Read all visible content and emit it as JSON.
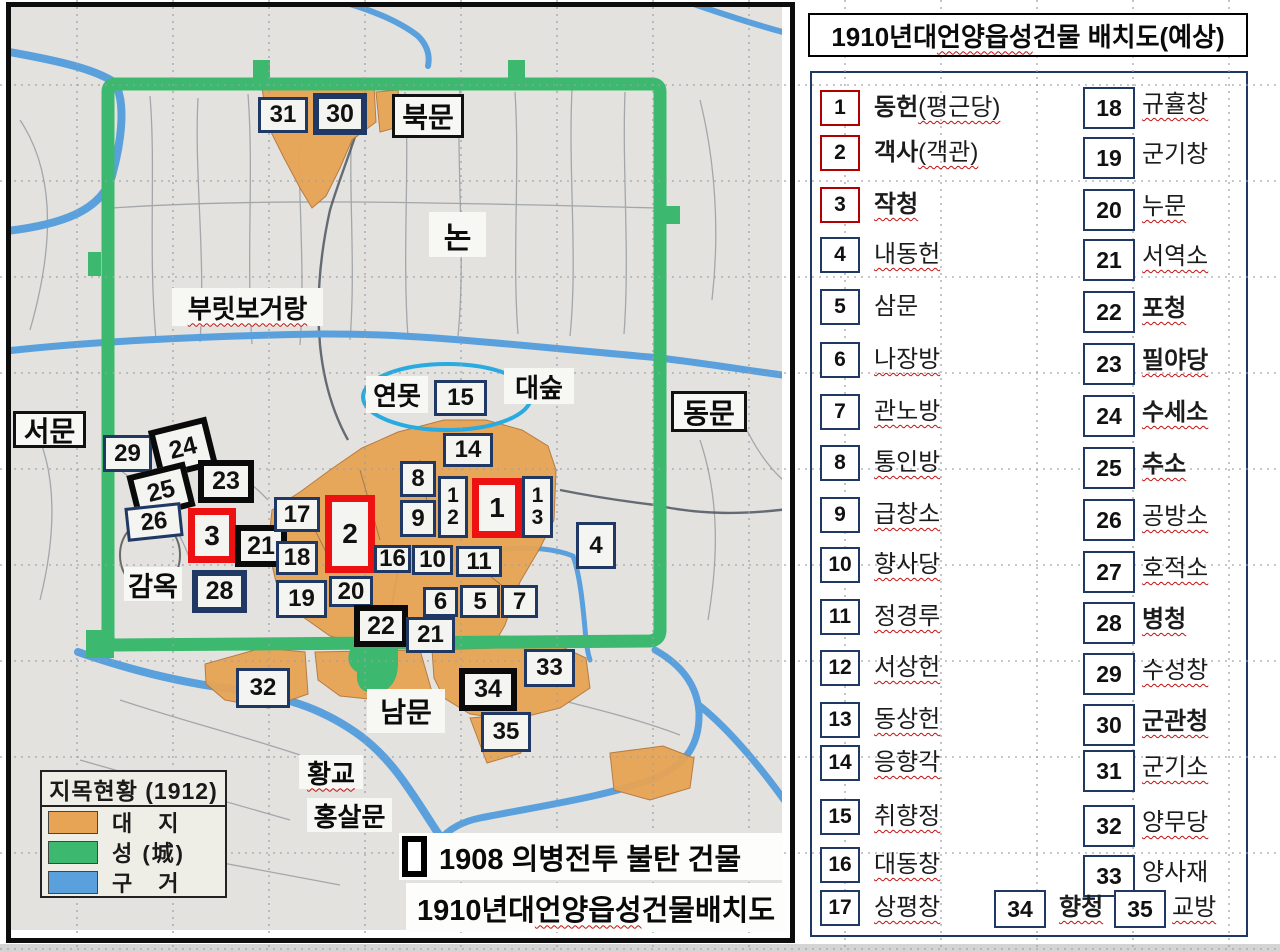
{
  "panel": {
    "title": {
      "prefix": "1910년대 ",
      "underlined": "언양읍성",
      "suffix": " 건물 배치도(예상)"
    },
    "items": [
      {
        "no": "1",
        "label": "동헌",
        "paren": "(평근당)",
        "bold": true,
        "red": true,
        "wavy": true,
        "col": "L"
      },
      {
        "no": "2",
        "label": "객사",
        "paren": "(객관)",
        "bold": true,
        "red": true,
        "wavy": true,
        "col": "L"
      },
      {
        "no": "3",
        "label": "작청",
        "paren": "",
        "bold": true,
        "red": true,
        "wavy": true,
        "col": "L"
      },
      {
        "no": "4",
        "label": "내동헌",
        "paren": "",
        "bold": false,
        "red": false,
        "wavy": true,
        "col": "L"
      },
      {
        "no": "5",
        "label": "삼문",
        "paren": "",
        "bold": false,
        "red": false,
        "wavy": false,
        "col": "L"
      },
      {
        "no": "6",
        "label": "나장방",
        "paren": "",
        "bold": false,
        "red": false,
        "wavy": true,
        "col": "L"
      },
      {
        "no": "7",
        "label": "관노방",
        "paren": "",
        "bold": false,
        "red": false,
        "wavy": true,
        "col": "L"
      },
      {
        "no": "8",
        "label": "통인방",
        "paren": "",
        "bold": false,
        "red": false,
        "wavy": true,
        "col": "L"
      },
      {
        "no": "9",
        "label": "급창소",
        "paren": "",
        "bold": false,
        "red": false,
        "wavy": true,
        "col": "L"
      },
      {
        "no": "10",
        "label": "향사당",
        "paren": "",
        "bold": false,
        "red": false,
        "wavy": true,
        "col": "L"
      },
      {
        "no": "11",
        "label": "정경루",
        "paren": "",
        "bold": false,
        "red": false,
        "wavy": true,
        "col": "L"
      },
      {
        "no": "12",
        "label": "서상헌",
        "paren": "",
        "bold": false,
        "red": false,
        "wavy": true,
        "col": "L"
      },
      {
        "no": "13",
        "label": "동상헌",
        "paren": "",
        "bold": false,
        "red": false,
        "wavy": true,
        "col": "L"
      },
      {
        "no": "14",
        "label": "응향각",
        "paren": "",
        "bold": false,
        "red": false,
        "wavy": true,
        "col": "L"
      },
      {
        "no": "15",
        "label": "취향정",
        "paren": "",
        "bold": false,
        "red": false,
        "wavy": true,
        "col": "L"
      },
      {
        "no": "16",
        "label": "대동창",
        "paren": "",
        "bold": false,
        "red": false,
        "wavy": true,
        "col": "L"
      },
      {
        "no": "17",
        "label": "상평창",
        "paren": "",
        "bold": false,
        "red": false,
        "wavy": true,
        "col": "L"
      },
      {
        "no": "18",
        "label": "규휼창",
        "paren": "",
        "bold": false,
        "red": false,
        "wavy": true,
        "col": "R"
      },
      {
        "no": "19",
        "label": "군기창",
        "paren": "",
        "bold": false,
        "red": false,
        "wavy": false,
        "col": "R"
      },
      {
        "no": "20",
        "label": "누문",
        "paren": "",
        "bold": false,
        "red": false,
        "wavy": true,
        "col": "R"
      },
      {
        "no": "21",
        "label": "서역소",
        "paren": "",
        "bold": false,
        "red": false,
        "wavy": true,
        "col": "R"
      },
      {
        "no": "22",
        "label": "포청",
        "paren": "",
        "bold": true,
        "red": false,
        "wavy": true,
        "col": "R"
      },
      {
        "no": "23",
        "label": "필야당",
        "paren": "",
        "bold": true,
        "red": false,
        "wavy": true,
        "col": "R"
      },
      {
        "no": "24",
        "label": "수세소",
        "paren": "",
        "bold": true,
        "red": false,
        "wavy": true,
        "col": "R"
      },
      {
        "no": "25",
        "label": "추소",
        "paren": "",
        "bold": true,
        "red": false,
        "wavy": true,
        "col": "R"
      },
      {
        "no": "26",
        "label": "공방소",
        "paren": "",
        "bold": false,
        "red": false,
        "wavy": true,
        "col": "R"
      },
      {
        "no": "27",
        "label": "호적소",
        "paren": "",
        "bold": false,
        "red": false,
        "wavy": true,
        "col": "R"
      },
      {
        "no": "28",
        "label": "병청",
        "paren": "",
        "bold": true,
        "red": false,
        "wavy": true,
        "col": "R"
      },
      {
        "no": "29",
        "label": "수성창",
        "paren": "",
        "bold": false,
        "red": false,
        "wavy": true,
        "col": "R"
      },
      {
        "no": "30",
        "label": "군관청",
        "paren": "",
        "bold": true,
        "red": false,
        "wavy": true,
        "col": "R"
      },
      {
        "no": "31",
        "label": "군기소",
        "paren": "",
        "bold": false,
        "red": false,
        "wavy": true,
        "col": "R"
      },
      {
        "no": "32",
        "label": "양무당",
        "paren": "",
        "bold": false,
        "red": false,
        "wavy": true,
        "col": "R"
      },
      {
        "no": "33",
        "label": "양사재",
        "paren": "",
        "bold": false,
        "red": false,
        "wavy": false,
        "col": "R"
      },
      {
        "no": "34",
        "label": "향청",
        "paren": "",
        "bold": true,
        "red": false,
        "wavy": true,
        "col": "B"
      },
      {
        "no": "35",
        "label": "교방",
        "paren": "",
        "bold": false,
        "red": false,
        "wavy": true,
        "col": "B"
      }
    ]
  },
  "map": {
    "colors": {
      "wall": "#3cb96e",
      "site": "#e8a455",
      "water": "#5aa0dd",
      "paper": "#e3e2de",
      "navy": "#1f3864",
      "red": "#ee1111"
    },
    "legend": {
      "title": "지목현황 (1912)",
      "rows": [
        {
          "label": "대　지",
          "color": "#e8a455"
        },
        {
          "label": "성 (城)",
          "color": "#3cb96e"
        },
        {
          "label": "구　거",
          "color": "#5aa0dd"
        }
      ]
    },
    "captions": {
      "burned": "1908 의병전투 불탄 건물",
      "layout": {
        "prefix": "1910년대 ",
        "underlined": "언양읍성",
        "suffix": " 건물배치도"
      }
    },
    "labels": [
      {
        "text": "북문",
        "x": 392,
        "y": 94,
        "w": 72,
        "h": 44,
        "border": true,
        "fs": 28
      },
      {
        "text": "논",
        "x": 429,
        "y": 212,
        "w": 57,
        "h": 45,
        "border": false,
        "fs": 30
      },
      {
        "text": "부릿보거랑",
        "x": 172,
        "y": 288,
        "w": 151,
        "h": 38,
        "border": false,
        "fs": 26,
        "wavy": true
      },
      {
        "text": "서문",
        "x": 13,
        "y": 411,
        "w": 73,
        "h": 37,
        "border": true,
        "fs": 28
      },
      {
        "text": "연못",
        "x": 366,
        "y": 376,
        "w": 62,
        "h": 37,
        "border": false,
        "fs": 26
      },
      {
        "text": "대숲",
        "x": 504,
        "y": 368,
        "w": 70,
        "h": 36,
        "border": false,
        "fs": 26
      },
      {
        "text": "동문",
        "x": 671,
        "y": 391,
        "w": 76,
        "h": 41,
        "border": true,
        "fs": 28
      },
      {
        "text": "감옥",
        "x": 124,
        "y": 567,
        "w": 58,
        "h": 34,
        "border": false,
        "fs": 27
      },
      {
        "text": "남문",
        "x": 367,
        "y": 689,
        "w": 78,
        "h": 44,
        "border": false,
        "fs": 28
      },
      {
        "text": "황교",
        "x": 299,
        "y": 755,
        "w": 64,
        "h": 34,
        "border": false,
        "fs": 26,
        "wavy": true
      },
      {
        "text": "홍살문",
        "x": 307,
        "y": 798,
        "w": 85,
        "h": 34,
        "border": false,
        "fs": 26
      }
    ],
    "boxes": [
      {
        "no": "31",
        "x": 258,
        "y": 97,
        "w": 50,
        "h": 36,
        "style": "navy"
      },
      {
        "no": "30",
        "x": 313,
        "y": 93,
        "w": 54,
        "h": 42,
        "style": "navyThick"
      },
      {
        "no": "29",
        "x": 103,
        "y": 435,
        "w": 49,
        "h": 37,
        "style": "navy"
      },
      {
        "no": "24",
        "x": 153,
        "y": 423,
        "w": 60,
        "h": 50,
        "style": "black",
        "rot": -14
      },
      {
        "no": "25",
        "x": 131,
        "y": 468,
        "w": 60,
        "h": 46,
        "style": "black",
        "rot": -14
      },
      {
        "no": "23",
        "x": 198,
        "y": 460,
        "w": 56,
        "h": 43,
        "style": "black"
      },
      {
        "no": "26",
        "x": 126,
        "y": 505,
        "w": 56,
        "h": 34,
        "style": "navy",
        "rot": -6
      },
      {
        "no": "3",
        "x": 188,
        "y": 508,
        "w": 48,
        "h": 55,
        "style": "red"
      },
      {
        "no": "21",
        "x": 235,
        "y": 525,
        "w": 52,
        "h": 42,
        "style": "black"
      },
      {
        "no": "17",
        "x": 274,
        "y": 497,
        "w": 46,
        "h": 35,
        "style": "navy"
      },
      {
        "no": "2",
        "x": 325,
        "y": 495,
        "w": 50,
        "h": 78,
        "style": "red"
      },
      {
        "no": "18",
        "x": 276,
        "y": 541,
        "w": 42,
        "h": 34,
        "style": "navy"
      },
      {
        "no": "28",
        "x": 192,
        "y": 570,
        "w": 55,
        "h": 43,
        "style": "navyThick"
      },
      {
        "no": "19",
        "x": 276,
        "y": 580,
        "w": 51,
        "h": 38,
        "style": "navy"
      },
      {
        "no": "20",
        "x": 329,
        "y": 576,
        "w": 44,
        "h": 31,
        "style": "navy"
      },
      {
        "no": "22",
        "x": 354,
        "y": 605,
        "w": 54,
        "h": 42,
        "style": "black"
      },
      {
        "no": "21",
        "x": 406,
        "y": 617,
        "w": 49,
        "h": 36,
        "style": "navy"
      },
      {
        "no": "16",
        "x": 374,
        "y": 545,
        "w": 37,
        "h": 28,
        "style": "navy"
      },
      {
        "no": "10",
        "x": 412,
        "y": 545,
        "w": 41,
        "h": 30,
        "style": "navy"
      },
      {
        "no": "11",
        "x": 456,
        "y": 546,
        "w": 46,
        "h": 31,
        "style": "navy"
      },
      {
        "no": "6",
        "x": 423,
        "y": 587,
        "w": 35,
        "h": 30,
        "style": "navy"
      },
      {
        "no": "5",
        "x": 460,
        "y": 585,
        "w": 40,
        "h": 33,
        "style": "navy"
      },
      {
        "no": "7",
        "x": 501,
        "y": 585,
        "w": 37,
        "h": 33,
        "style": "navy"
      },
      {
        "no": "8",
        "x": 400,
        "y": 461,
        "w": 36,
        "h": 36,
        "style": "navy"
      },
      {
        "no": "9",
        "x": 400,
        "y": 500,
        "w": 36,
        "h": 37,
        "style": "navy"
      },
      {
        "no": "1\n2",
        "x": 438,
        "y": 476,
        "w": 30,
        "h": 62,
        "style": "navy",
        "vtext": true
      },
      {
        "no": "1",
        "x": 472,
        "y": 478,
        "w": 50,
        "h": 60,
        "style": "red"
      },
      {
        "no": "1\n3",
        "x": 522,
        "y": 476,
        "w": 31,
        "h": 62,
        "style": "navy",
        "vtext": true
      },
      {
        "no": "14",
        "x": 443,
        "y": 433,
        "w": 50,
        "h": 34,
        "style": "navy"
      },
      {
        "no": "15",
        "x": 434,
        "y": 380,
        "w": 53,
        "h": 36,
        "style": "navy"
      },
      {
        "no": "4",
        "x": 576,
        "y": 522,
        "w": 40,
        "h": 47,
        "style": "navy"
      },
      {
        "no": "32",
        "x": 236,
        "y": 668,
        "w": 54,
        "h": 40,
        "style": "navy"
      },
      {
        "no": "33",
        "x": 524,
        "y": 649,
        "w": 51,
        "h": 38,
        "style": "navy"
      },
      {
        "no": "34",
        "x": 459,
        "y": 668,
        "w": 58,
        "h": 43,
        "style": "black"
      },
      {
        "no": "35",
        "x": 481,
        "y": 712,
        "w": 50,
        "h": 40,
        "style": "navy"
      }
    ]
  }
}
